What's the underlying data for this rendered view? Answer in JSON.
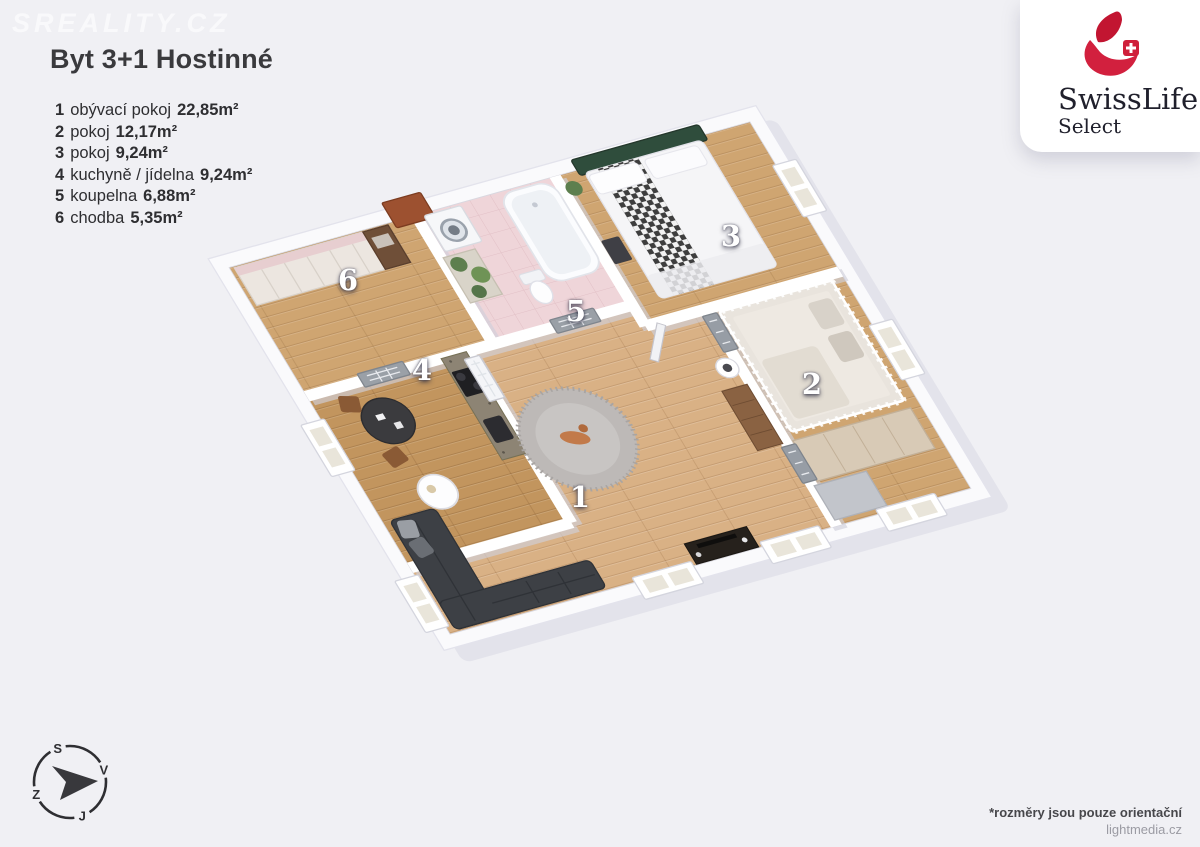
{
  "watermark": "SREALITY.CZ",
  "header": {
    "title": "Byt 3+1 Hostinné"
  },
  "legend": {
    "items": [
      {
        "num": "1",
        "name": "obývací pokoj",
        "area": "22,85m²"
      },
      {
        "num": "2",
        "name": "pokoj",
        "area": "12,17m²"
      },
      {
        "num": "3",
        "name": "pokoj",
        "area": "9,24m²"
      },
      {
        "num": "4",
        "name": "kuchyně / jídelna",
        "area": "9,24m²"
      },
      {
        "num": "5",
        "name": "koupelna",
        "area": "6,88m²"
      },
      {
        "num": "6",
        "name": "chodba",
        "area": "5,35m²"
      }
    ]
  },
  "logo": {
    "brand": "SwissLife",
    "sub": "Select",
    "accent": "#cf1f3a"
  },
  "plan": {
    "room_labels": [
      {
        "num": "1"
      },
      {
        "num": "2"
      },
      {
        "num": "3"
      },
      {
        "num": "4"
      },
      {
        "num": "5"
      },
      {
        "num": "6"
      }
    ]
  },
  "compass": {
    "north": "S",
    "east": "V",
    "south": "J",
    "west": "Z"
  },
  "footer": {
    "disclaimer": "*rozměry jsou pouze orientační",
    "credit": "lightmedia.cz"
  },
  "colors": {
    "background": "#f0f0f4",
    "brand_red": "#cf1f3a",
    "floor_wood_light": "#d9b185",
    "floor_wood_mid": "#cfa571",
    "floor_wood_dark": "#c2955e",
    "bath_pink": "#efd5d9",
    "headboard_green": "#2f4d3c",
    "sofa_gray": "#3d4045"
  }
}
